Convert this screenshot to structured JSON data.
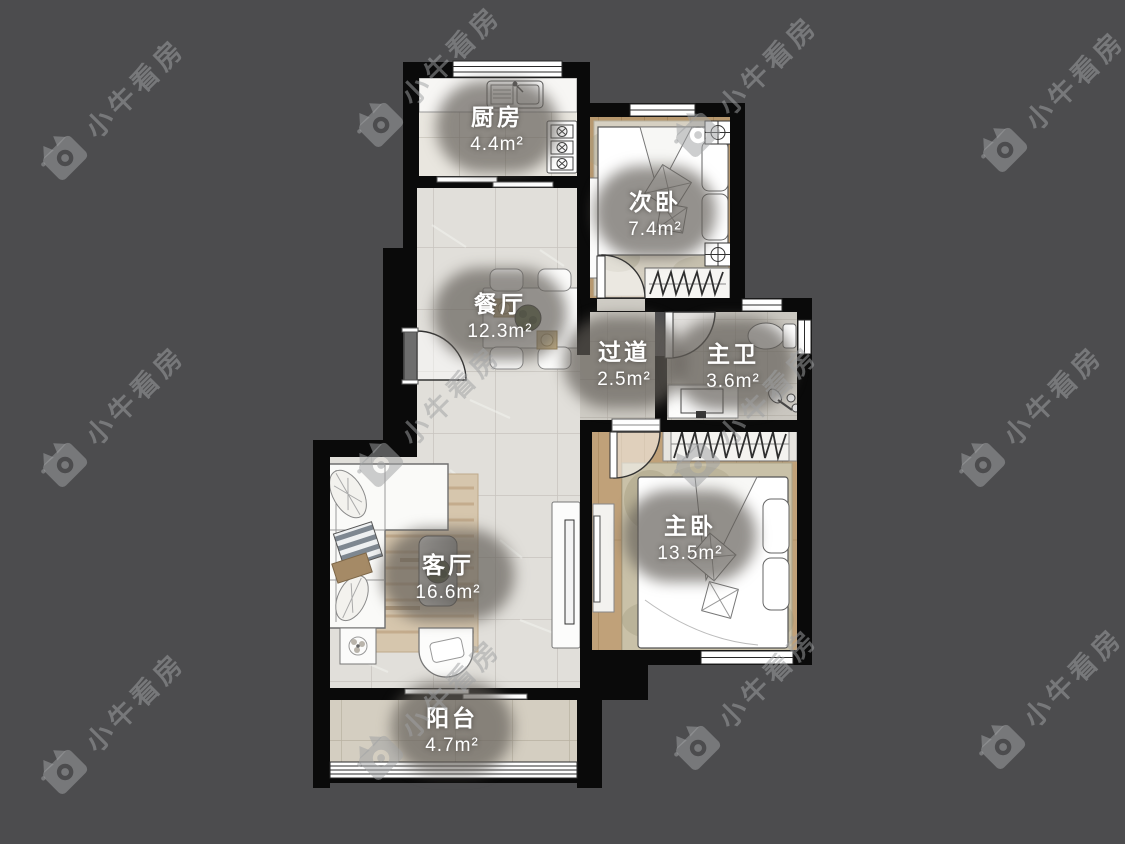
{
  "watermark": {
    "text": "小牛看房"
  },
  "rooms": [
    {
      "id": "kitchen",
      "name": "厨房",
      "area": "4.4m²",
      "cx": 497,
      "cy": 127
    },
    {
      "id": "second-bedroom",
      "name": "次卧",
      "area": "7.4m²",
      "cx": 655,
      "cy": 212
    },
    {
      "id": "dining-room",
      "name": "餐厅",
      "area": "12.3m²",
      "cx": 500,
      "cy": 314
    },
    {
      "id": "hallway",
      "name": "过道",
      "area": "2.5m²",
      "cx": 624,
      "cy": 362
    },
    {
      "id": "master-bathroom",
      "name": "主卫",
      "area": "3.6m²",
      "cx": 733,
      "cy": 364
    },
    {
      "id": "master-bedroom",
      "name": "主卧",
      "area": "13.5m²",
      "cx": 690,
      "cy": 536
    },
    {
      "id": "living-room",
      "name": "客厅",
      "area": "16.6m²",
      "cx": 448,
      "cy": 575
    },
    {
      "id": "balcony",
      "name": "阳台",
      "area": "4.7m²",
      "cx": 452,
      "cy": 728
    }
  ]
}
